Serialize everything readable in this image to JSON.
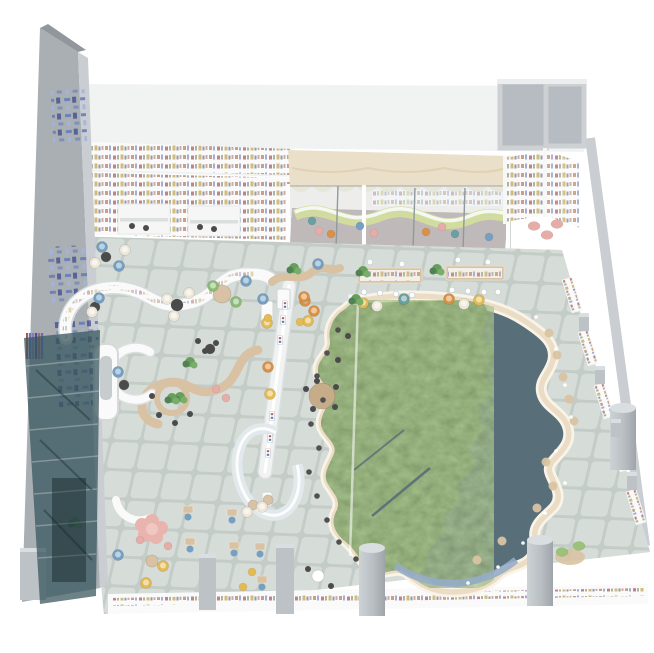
{
  "scene": {
    "description": "isometric 3D render of a children's library reading hall with a map-themed pond feature",
    "background": "#ffffff",
    "elements": [
      "left-mural-wall",
      "glass-stairwell",
      "back-bookshelf-wall",
      "reading-alcoves",
      "kids-glass-rooms",
      "scalloped-canopy",
      "corner-book-nook",
      "storage-rooms",
      "tiled-floor",
      "map-pond",
      "pond-glass-divider",
      "curved-bookshelf",
      "curved-planter-bench",
      "display-spine-wall",
      "ring-counter",
      "round-booth",
      "reception-desk",
      "reading-tables",
      "armchair-lounge",
      "study-carrels",
      "columns",
      "perimeter-low-shelves"
    ]
  },
  "palette": {
    "white": "#ffffff",
    "backBand": "#eef0f1",
    "floor": "#ccd4d0",
    "tileGap": "#bec8c3",
    "tileFill": "#d3dad6",
    "wall": "#a6acb2",
    "wallEdge": "#8d9499",
    "wallFace": "#c6cbd0",
    "roomWall": "#c9ced2",
    "roomFloor": "#b2b9bf",
    "shelfWhite": "#f7f8f8",
    "canopy": "#e9dcc2",
    "canopyShade": "#dcc9a6",
    "kidsFloor": "#a28e8c",
    "kidsWall": "#efe9e4",
    "wave": "#c6d355",
    "glassTint": "rgba(226,239,243,0.38)",
    "glassLine": "#8b969b",
    "stairGlass": "rgba(47,82,91,0.74)",
    "water": "#516a76",
    "land": "#5e7b4b",
    "pondBorder": "#eadabe",
    "pondBorderOuter": "#f7f0e4",
    "blueStrip": "#8fa9c9",
    "wood": "#d9bf9c",
    "woodDark": "#c6a87f",
    "spine": "#eef0f1",
    "columnGray": "#b9bfc4",
    "columnLight": "#d6dbde",
    "chairBlue": "#6d9cc4",
    "chairTeal": "#5f9ea0",
    "chairOrange": "#df8c35",
    "chairYellow": "#e5b844",
    "chairCream": "#eae4d4",
    "chairGreen": "#83bb6a",
    "chairDark": "#474747",
    "poufPink": "#eaa8a2",
    "beanGreen": "#95c16d",
    "cushionTan": "#d9c09a",
    "plantGreen": "#5f9d50",
    "plantDark": "#47804a",
    "plantLight": "#6fae5c",
    "mural": "#5a74c2"
  },
  "furniture": {
    "armchairs": [
      [
        102,
        247,
        "chairBlue"
      ],
      [
        125,
        250,
        "chairCream"
      ],
      [
        95,
        263,
        "chairCream"
      ],
      [
        119,
        266,
        "chairBlue"
      ],
      [
        99,
        298,
        "chairBlue"
      ],
      [
        92,
        312,
        "chairCream"
      ],
      [
        246,
        281,
        "chairBlue"
      ],
      [
        213,
        286,
        "chairGreen"
      ],
      [
        236,
        302,
        "chairGreen"
      ],
      [
        167,
        299,
        "chairCream"
      ],
      [
        189,
        293,
        "chairCream"
      ],
      [
        174,
        316,
        "chairCream"
      ],
      [
        263,
        299,
        "chairBlue"
      ],
      [
        305,
        301,
        "chairOrange"
      ],
      [
        267,
        323,
        "chairYellow"
      ],
      [
        308,
        321,
        "chairYellow"
      ],
      [
        268,
        367,
        "chairOrange"
      ],
      [
        270,
        394,
        "chairYellow"
      ],
      [
        363,
        303,
        "chairYellow"
      ],
      [
        377,
        306,
        "chairCream"
      ],
      [
        404,
        299,
        "chairTeal"
      ],
      [
        449,
        299,
        "chairOrange"
      ],
      [
        464,
        304,
        "chairCream"
      ],
      [
        479,
        300,
        "chairYellow"
      ],
      [
        318,
        264,
        "chairBlue"
      ],
      [
        304,
        297,
        "chairOrange"
      ],
      [
        314,
        311,
        "chairOrange"
      ],
      [
        118,
        372,
        "chairBlue"
      ],
      [
        118,
        555,
        "chairBlue"
      ],
      [
        146,
        583,
        "chairYellow"
      ],
      [
        163,
        566,
        "chairYellow"
      ],
      [
        247,
        512,
        "chairCream"
      ],
      [
        262,
        507,
        "chairCream"
      ]
    ],
    "poufs": [
      [
        312,
        221,
        "chairTeal"
      ],
      [
        319,
        231,
        "poufPink"
      ],
      [
        331,
        234,
        "chairOrange"
      ],
      [
        360,
        226,
        "chairBlue"
      ],
      [
        374,
        233,
        "poufPink"
      ],
      [
        426,
        232,
        "chairOrange"
      ],
      [
        442,
        227,
        "poufPink"
      ],
      [
        455,
        234,
        "chairTeal"
      ],
      [
        489,
        237,
        "chairBlue"
      ],
      [
        216,
        389,
        "poufPink"
      ],
      [
        226,
        398,
        "poufPink"
      ],
      [
        140,
        540,
        "poufPink"
      ],
      [
        168,
        546,
        "poufPink"
      ],
      [
        252,
        572,
        "chairYellow"
      ],
      [
        243,
        587,
        "chairYellow"
      ],
      [
        300,
        322,
        "chairYellow"
      ],
      [
        268,
        318,
        "chairYellow"
      ]
    ],
    "darkChairs": [
      [
        152,
        396
      ],
      [
        159,
        415
      ],
      [
        175,
        423
      ],
      [
        190,
        414
      ],
      [
        205,
        351
      ],
      [
        216,
        343
      ],
      [
        198,
        341
      ],
      [
        306,
        389
      ],
      [
        317,
        381
      ],
      [
        336,
        387
      ],
      [
        335,
        407
      ],
      [
        313,
        409
      ],
      [
        308,
        569
      ],
      [
        331,
        586
      ],
      [
        132,
        226
      ],
      [
        146,
        228
      ],
      [
        200,
        227
      ],
      [
        214,
        229
      ],
      [
        348,
        336
      ],
      [
        338,
        360
      ]
    ],
    "tables": [
      [
        106,
        257,
        5,
        "chairDark"
      ],
      [
        95,
        307,
        5,
        "chairDark"
      ],
      [
        177,
        305,
        6,
        "chairDark"
      ],
      [
        124,
        385,
        5,
        "chairDark"
      ],
      [
        210,
        349,
        5,
        "chairDark"
      ],
      [
        322,
        396,
        13,
        "woodDark"
      ],
      [
        318,
        576,
        6,
        "white"
      ],
      [
        152,
        561,
        6,
        "wood"
      ],
      [
        253,
        505,
        5,
        "wood"
      ],
      [
        268,
        500,
        5,
        "wood"
      ],
      [
        222,
        294,
        9,
        "wood"
      ]
    ],
    "whiteStools": [
      [
        364,
        292
      ],
      [
        380,
        293
      ],
      [
        396,
        294
      ],
      [
        412,
        295
      ],
      [
        370,
        262
      ],
      [
        402,
        264
      ],
      [
        452,
        290
      ],
      [
        468,
        291
      ],
      [
        484,
        292
      ],
      [
        498,
        292
      ],
      [
        458,
        260
      ],
      [
        488,
        262
      ]
    ],
    "plants": [
      [
        363,
        271
      ],
      [
        437,
        269
      ],
      [
        294,
        268
      ],
      [
        190,
        362
      ],
      [
        180,
        397
      ],
      [
        356,
        299
      ],
      [
        75,
        522
      ],
      [
        172,
        398
      ]
    ],
    "cushions": [
      [
        549,
        333
      ],
      [
        557,
        355
      ],
      [
        563,
        377
      ],
      [
        569,
        399
      ],
      [
        574,
        421
      ],
      [
        546,
        462
      ],
      [
        553,
        486
      ],
      [
        537,
        508
      ],
      [
        502,
        541
      ],
      [
        477,
        560
      ]
    ],
    "pondStools": [
      [
        338,
        330
      ],
      [
        327,
        353
      ],
      [
        317,
        376
      ],
      [
        323,
        400
      ],
      [
        311,
        424
      ],
      [
        319,
        448
      ],
      [
        309,
        472
      ],
      [
        317,
        496
      ],
      [
        327,
        520
      ],
      [
        339,
        542
      ],
      [
        356,
        559
      ]
    ],
    "leds": [
      [
        536,
        317
      ],
      [
        556,
        349
      ],
      [
        565,
        385
      ],
      [
        571,
        417
      ],
      [
        556,
        451
      ],
      [
        565,
        483
      ],
      [
        545,
        513
      ],
      [
        523,
        543
      ],
      [
        498,
        567
      ],
      [
        468,
        583
      ]
    ],
    "beanbags": [
      [
        534,
        226,
        "poufPink"
      ],
      [
        547,
        235,
        "poufPink"
      ],
      [
        557,
        224,
        "poufPink"
      ],
      [
        562,
        552,
        "beanGreen"
      ],
      [
        579,
        546,
        "beanGreen"
      ]
    ],
    "carrels": [
      [
        232,
        520
      ],
      [
        234,
        553
      ],
      [
        260,
        554
      ],
      [
        262,
        587
      ],
      [
        188,
        517
      ],
      [
        190,
        549
      ]
    ],
    "displays": [
      [
        285,
        305
      ],
      [
        283,
        320
      ],
      [
        280,
        340
      ],
      [
        272,
        416
      ],
      [
        270,
        438
      ],
      [
        268,
        453
      ]
    ],
    "cylColumns": [
      [
        372,
        548,
        13,
        68
      ],
      [
        540,
        540,
        13,
        66
      ],
      [
        623,
        408,
        13,
        62
      ]
    ],
    "boxColumns": [
      [
        199,
        554,
        17,
        56
      ],
      [
        276,
        544,
        18,
        70
      ],
      [
        20,
        548,
        26,
        52
      ],
      [
        579,
        313,
        10,
        18
      ],
      [
        595,
        366,
        10,
        18
      ],
      [
        611,
        419,
        10,
        18
      ],
      [
        627,
        472,
        10,
        18
      ]
    ],
    "stairBars": [
      [
        "#b23a3a",
        26
      ],
      [
        "#4667c4",
        29
      ],
      [
        "#8a6cc9",
        32
      ],
      [
        "#30409a",
        35
      ],
      [
        "#c05555",
        38
      ],
      [
        "#5560d0",
        41
      ]
    ]
  }
}
